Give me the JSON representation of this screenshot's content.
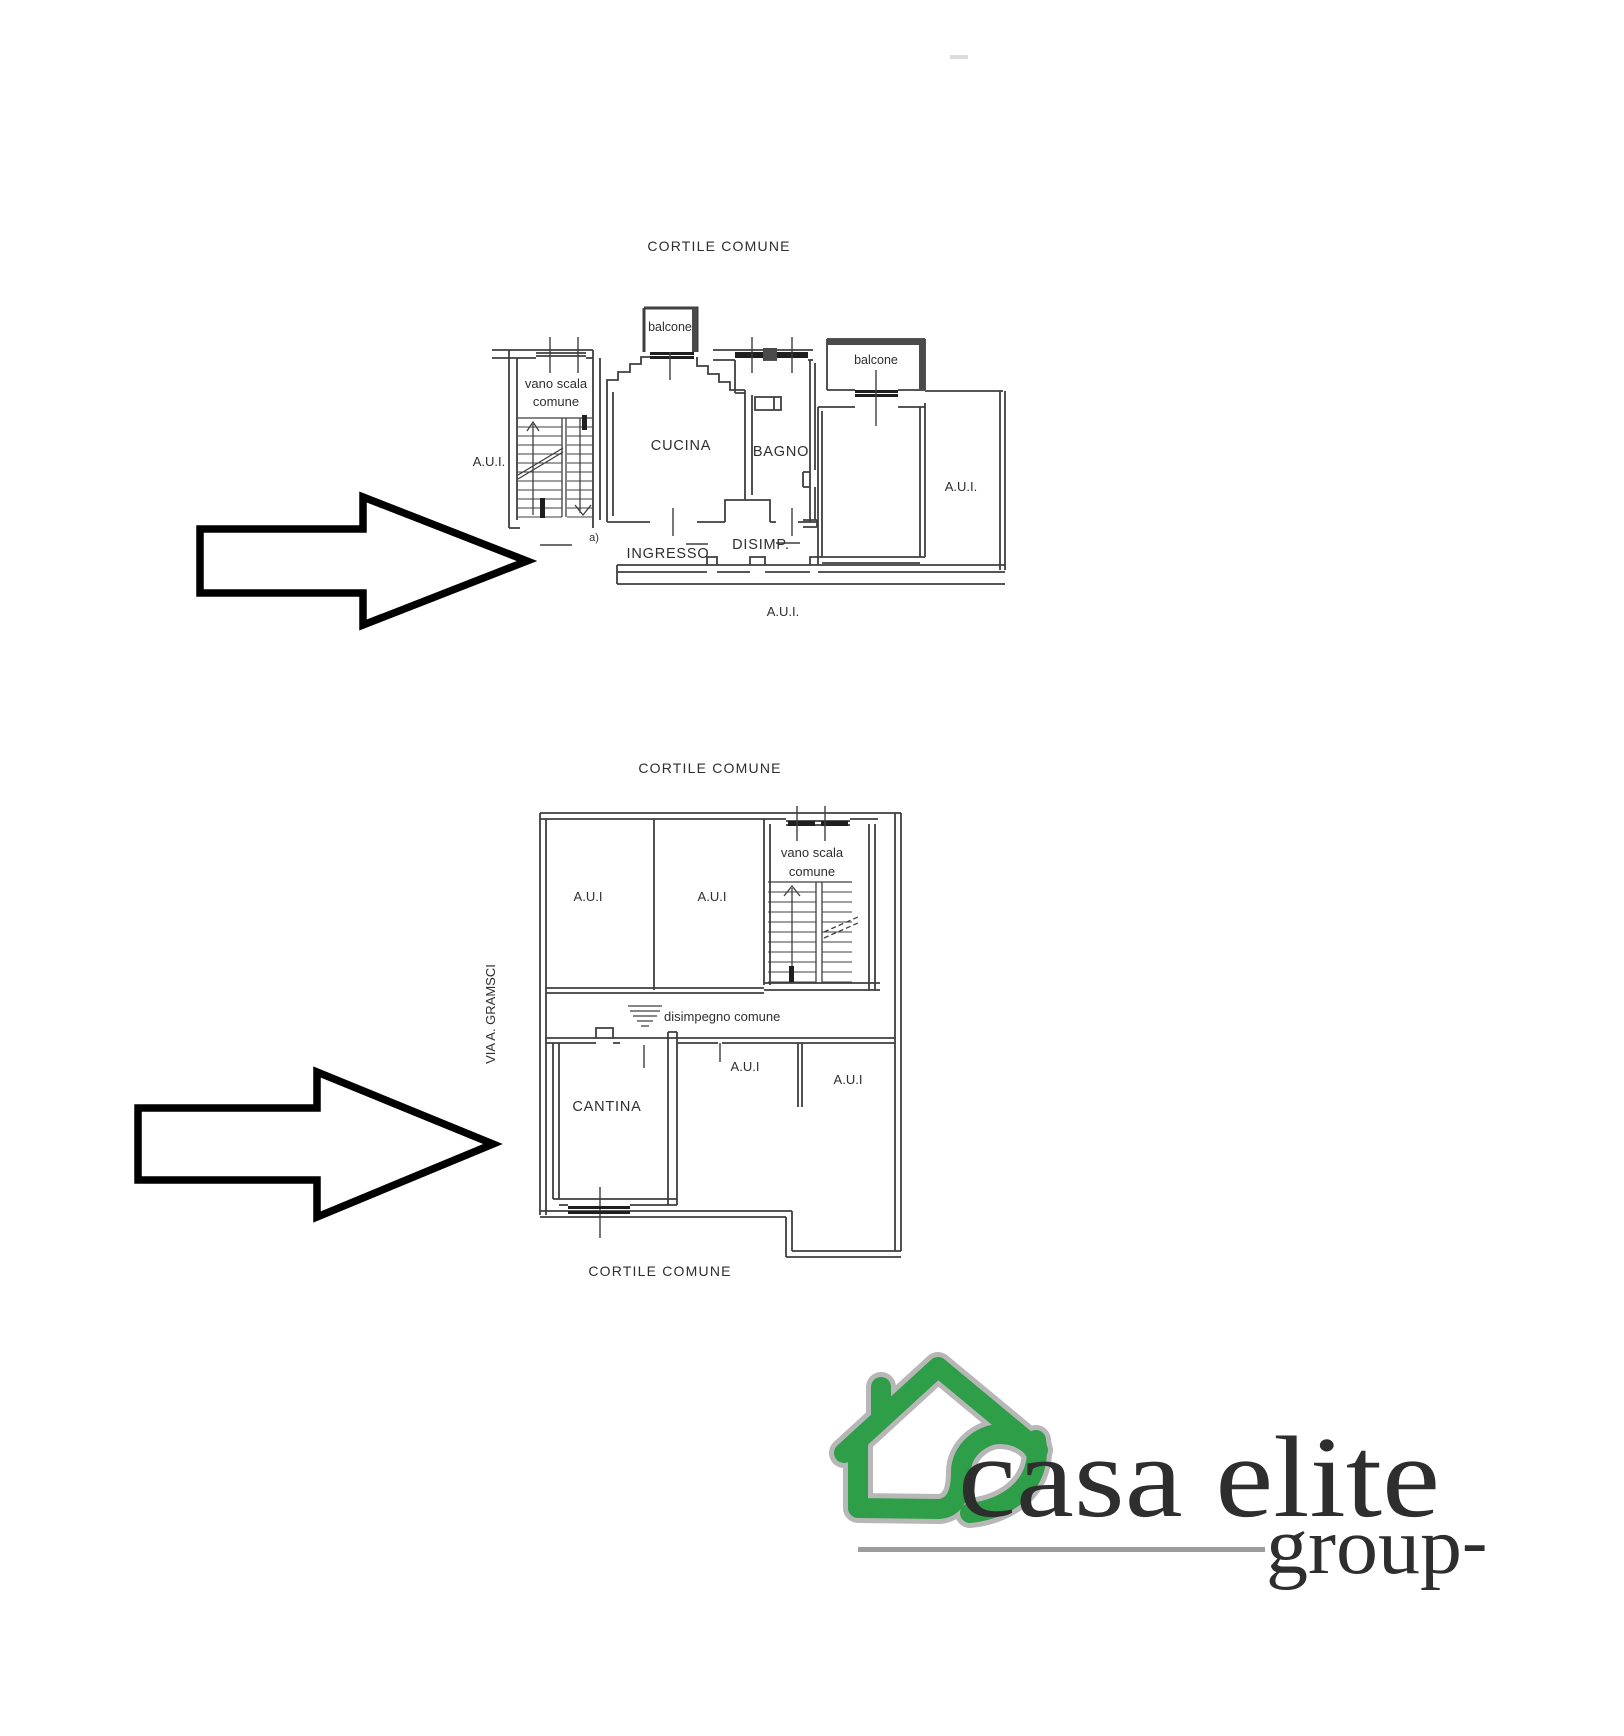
{
  "document": {
    "type": "planimetria-catastale",
    "background": "#ffffff",
    "line_color": "#3f3f3f"
  },
  "plans": {
    "upper": {
      "title": "CORTILE COMUNE",
      "labels": {
        "balcony_left": "balcone",
        "balcony_right": "balcone",
        "stairwell_line1": "vano scala",
        "stairwell_line2": "comune",
        "aui_left": "A.U.I.",
        "kitchen": "CUCINA",
        "bathroom": "BAGNO",
        "aui_right": "A.U.I.",
        "entrance": "INGRESSO",
        "hallway": "DISIMP.",
        "aui_bottom": "A.U.I.",
        "note": "a)"
      }
    },
    "lower": {
      "title": "CORTILE COMUNE",
      "labels": {
        "aui_room1": "A.U.I",
        "aui_room2": "A.U.I",
        "stairwell_line1": "vano scala",
        "stairwell_line2": "comune",
        "common_hallway": "disimpegno comune",
        "cellar": "CANTINA",
        "aui_room3": "A.U.I",
        "aui_room4": "A.U.I",
        "street": "VIA A. GRAMSCI",
        "courtyard_bottom": "CORTILE COMUNE"
      }
    }
  },
  "logo": {
    "brand": "casa elite",
    "sub": "group",
    "dash": "-",
    "green": "#2f9e48",
    "gray_border": "#b7b7b7",
    "text_gray": "#8c8c8c",
    "line_gray": "#9c9c9c"
  }
}
